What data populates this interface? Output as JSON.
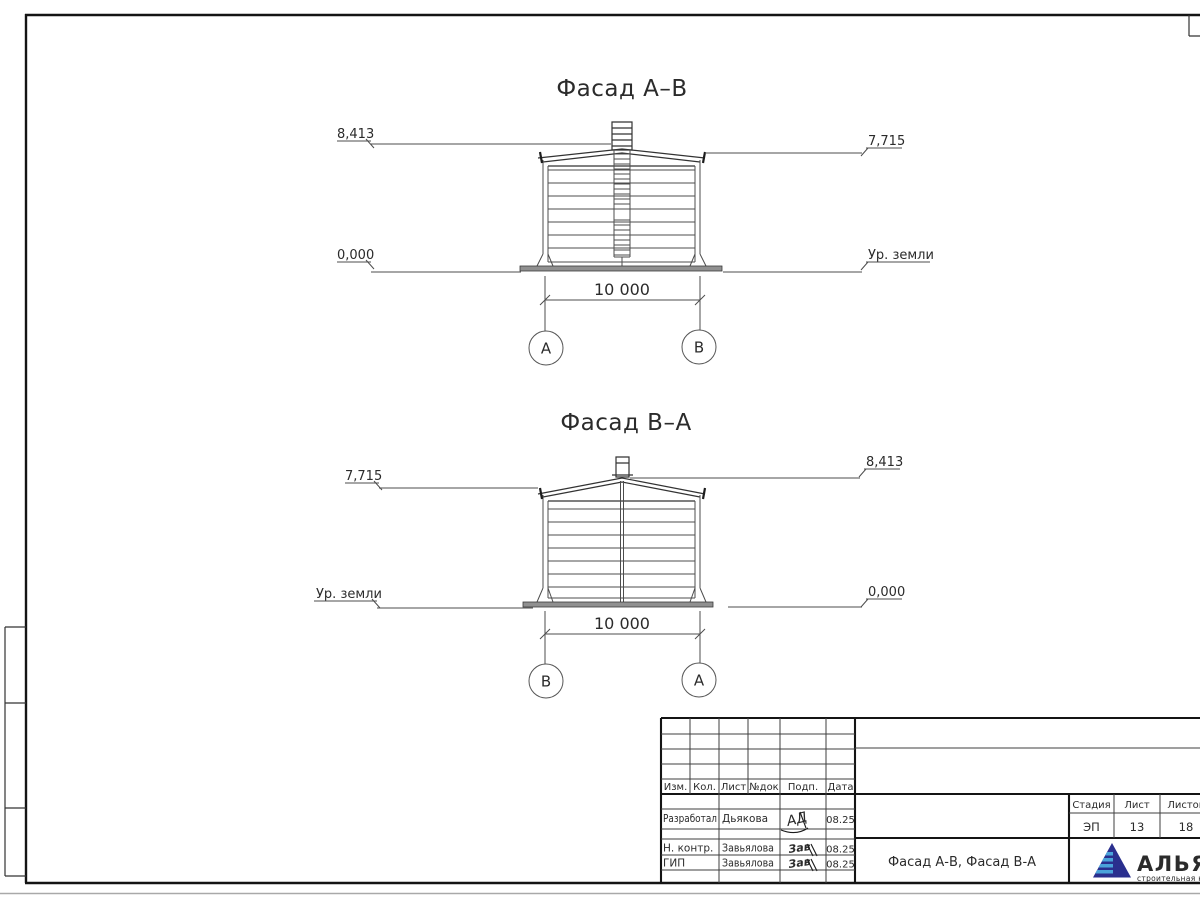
{
  "facades": [
    {
      "title": "Фасад А–В",
      "elev_top_left": "8,413",
      "elev_top_right": "7,715",
      "elev_bottom_left": "0,000",
      "elev_bottom_right": "Ур. земли",
      "dim": "10 000",
      "axis_left": "А",
      "axis_right": "В"
    },
    {
      "title": "Фасад В–А",
      "elev_top_left": "7,715",
      "elev_top_right": "8,413",
      "elev_bottom_left": "Ур. земли",
      "elev_bottom_right": "0,000",
      "dim": "10 000",
      "axis_left": "В",
      "axis_right": "А"
    }
  ],
  "title_block": {
    "columns": [
      "Изм.",
      "Кол.",
      "Лист",
      "№док",
      "Подп.",
      "Дата"
    ],
    "rows": [
      {
        "role": "Разработал",
        "name": "Дьякова",
        "sign": "АД",
        "date": "08.25"
      },
      {
        "role": "Н. контр.",
        "name": "Завьялова",
        "sign": "Зав",
        "date": "08.25"
      },
      {
        "role": "ГИП",
        "name": "Завьялова",
        "sign": "Зав",
        "date": "08.25"
      }
    ],
    "doc_title": "Фасад А-В, Фасад В-А",
    "stage_label": "Стадия",
    "sheet_label": "Лист",
    "sheets_label": "Листов",
    "stage": "ЭП",
    "sheet_num": "13",
    "sheets_total": "18"
  },
  "logo": {
    "name": "АЛЬЯНС",
    "subtitle": "строительная компания",
    "navy": "#2a2f8e",
    "light": "#4aa3da",
    "subtitle_color": "#6673c2"
  }
}
